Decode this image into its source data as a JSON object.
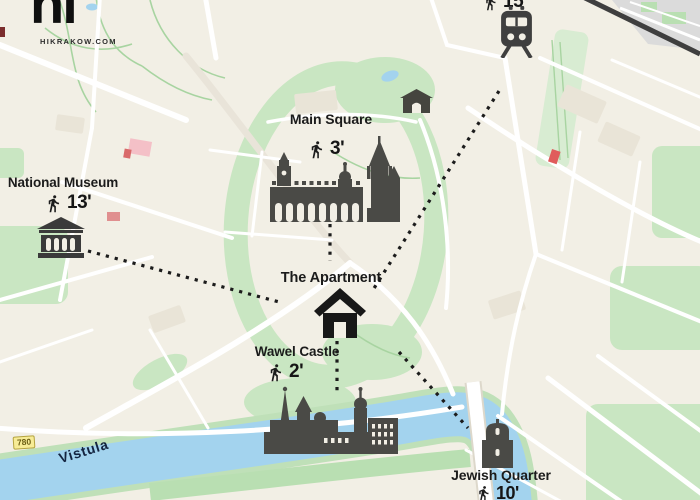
{
  "branding": {
    "logo": "hi",
    "website": "HIKRAKOW.COM"
  },
  "apartment": {
    "label": "The Apartment"
  },
  "pois": {
    "train_station": {
      "walk_time": "15'"
    },
    "main_square": {
      "label": "Main Square",
      "walk_time": "3'"
    },
    "national_museum": {
      "label": "National Museum",
      "walk_time": "13'"
    },
    "wawel_castle": {
      "label": "Wawel Castle",
      "walk_time": "2'"
    },
    "jewish_quarter": {
      "label": "Jewish Quarter",
      "walk_time": "10'"
    }
  },
  "map": {
    "river_label": "Vistula",
    "road_badge": "780"
  },
  "icons": {
    "walking": "walking-icon",
    "train": "train-icon",
    "house": "house-icon",
    "museum": "museum-building-icon",
    "cloth_hall": "cloth-hall-icon",
    "basilica": "st-marys-basilica-icon",
    "castle": "wawel-castle-icon",
    "synagogue": "synagogue-icon",
    "gate": "city-gate-icon"
  },
  "colors": {
    "background": "#f2efe5",
    "park_green": "#c9e6c2",
    "river_blue": "#a3d3ee",
    "road_white": "#ffffff",
    "ink": "#1b1b1b",
    "railway": "#3f3f3f",
    "badge_yellow": "#f7ec96",
    "river_label": "#13233f"
  }
}
